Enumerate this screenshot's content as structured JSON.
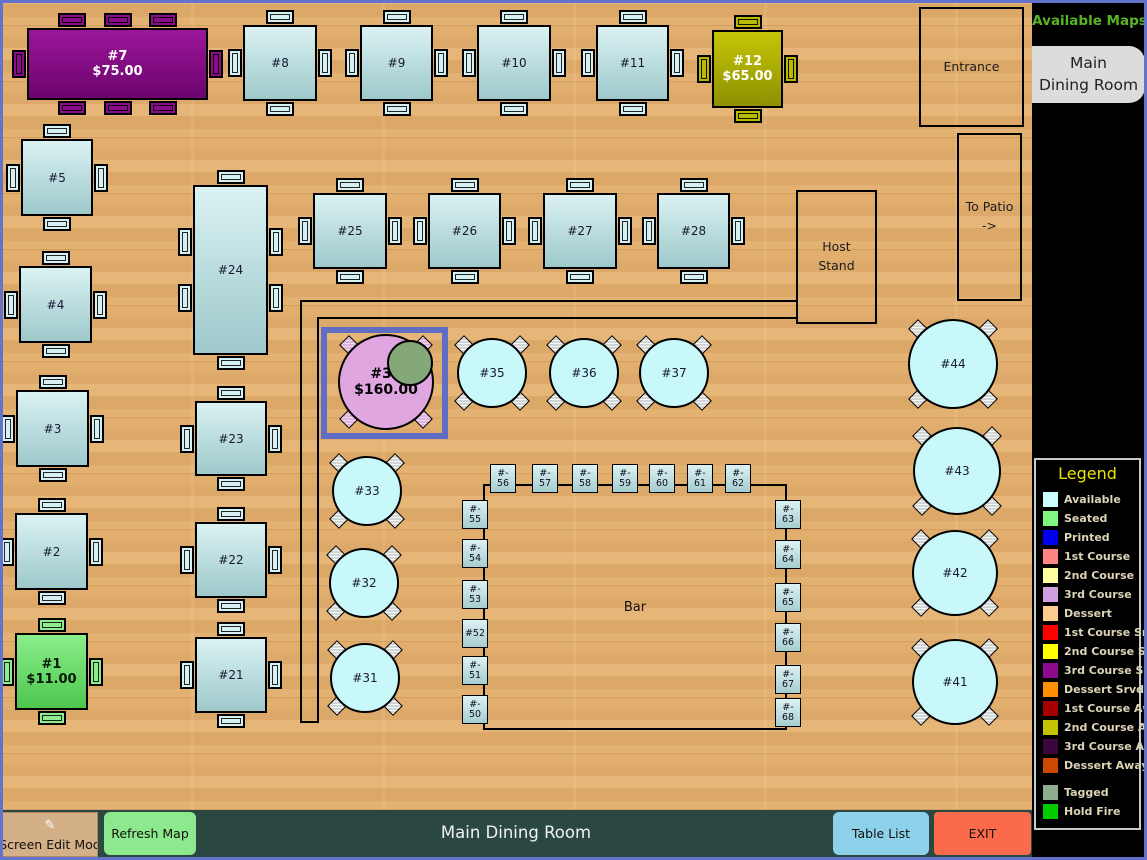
{
  "colors": {
    "frame": "#6372cb",
    "selection": "#5f6ec4",
    "wood": "#dfad6c",
    "bottombar": "#2b4741",
    "sidebar": "#000000"
  },
  "sidebar": {
    "title": "Available Maps",
    "active_map": "Main Dining Room",
    "active_map_lines": [
      "Main",
      "Dining Room"
    ],
    "legend": {
      "title": "Legend",
      "items": [
        {
          "label": "Available",
          "color": "#ccffff"
        },
        {
          "label": "Seated",
          "color": "#7ef87e"
        },
        {
          "label": "Printed",
          "color": "#0000f0"
        },
        {
          "label": "1st Course",
          "color": "#ff8585"
        },
        {
          "label": "2nd Course",
          "color": "#ffff9e"
        },
        {
          "label": "3rd Course",
          "color": "#cf9fe0"
        },
        {
          "label": "Dessert",
          "color": "#ffcc8e"
        },
        {
          "label": "1st Course Srvd",
          "color": "#ff0000"
        },
        {
          "label": "2nd Course Srvd",
          "color": "#ffff00"
        },
        {
          "label": "3rd Course Srvd",
          "color": "#8c0b8c"
        },
        {
          "label": "Dessert Srvd",
          "color": "#ff8e00"
        },
        {
          "label": "1st Course Away",
          "color": "#a40000"
        },
        {
          "label": "2nd Course Away",
          "color": "#c3c300"
        },
        {
          "label": "3rd Course Away",
          "color": "#3d063d"
        },
        {
          "label": "Dessert Away",
          "color": "#cc4a00"
        },
        {
          "label": "Tagged",
          "color": "#8cae8c",
          "gap": true
        },
        {
          "label": "Hold Fire",
          "color": "#00cc00"
        }
      ]
    }
  },
  "bottom_bar": {
    "edit_mode": "Screen Edit Mod",
    "refresh": "Refresh Map",
    "title": "Main Dining Room",
    "table_list": "Table List",
    "exit": "EXIT"
  },
  "map": {
    "walls": [
      {
        "x": 300,
        "y": 300,
        "w": 497,
        "h": 2
      },
      {
        "x": 317,
        "y": 317,
        "w": 480,
        "h": 2
      },
      {
        "x": 300,
        "y": 300,
        "w": 2,
        "h": 423
      },
      {
        "x": 317,
        "y": 317,
        "w": 2,
        "h": 404
      },
      {
        "x": 300,
        "y": 721,
        "w": 19,
        "h": 2
      }
    ],
    "rooms": [
      {
        "name": "entrance",
        "label": "Entrance",
        "x": 919,
        "y": 7,
        "w": 101,
        "h": 116
      },
      {
        "name": "to-patio",
        "label": "To Patio\n->",
        "x": 957,
        "y": 133,
        "w": 61,
        "h": 164
      },
      {
        "name": "host-stand",
        "label": "Host\nStand",
        "x": 796,
        "y": 190,
        "w": 77,
        "h": 130
      }
    ],
    "bar": {
      "label": "Bar",
      "x": 483,
      "y": 484,
      "w": 300,
      "h": 242,
      "seats": [
        {
          "lines": [
            "#-",
            "56"
          ],
          "x": 490,
          "y": 464
        },
        {
          "lines": [
            "#-",
            "57"
          ],
          "x": 532,
          "y": 464
        },
        {
          "lines": [
            "#-",
            "58"
          ],
          "x": 572,
          "y": 464
        },
        {
          "lines": [
            "#-",
            "59"
          ],
          "x": 612,
          "y": 464
        },
        {
          "lines": [
            "#-",
            "60"
          ],
          "x": 649,
          "y": 464
        },
        {
          "lines": [
            "#-",
            "61"
          ],
          "x": 687,
          "y": 464
        },
        {
          "lines": [
            "#-",
            "62"
          ],
          "x": 725,
          "y": 464
        },
        {
          "lines": [
            "#-",
            "55"
          ],
          "x": 462,
          "y": 500
        },
        {
          "lines": [
            "#-",
            "54"
          ],
          "x": 462,
          "y": 539
        },
        {
          "lines": [
            "#-",
            "53"
          ],
          "x": 462,
          "y": 580
        },
        {
          "lines": [
            "#52"
          ],
          "x": 462,
          "y": 619
        },
        {
          "lines": [
            "#-",
            "51"
          ],
          "x": 462,
          "y": 656
        },
        {
          "lines": [
            "#-",
            "50"
          ],
          "x": 462,
          "y": 695
        },
        {
          "lines": [
            "#-",
            "63"
          ],
          "x": 775,
          "y": 500
        },
        {
          "lines": [
            "#-",
            "64"
          ],
          "x": 775,
          "y": 540
        },
        {
          "lines": [
            "#-",
            "65"
          ],
          "x": 775,
          "y": 583
        },
        {
          "lines": [
            "#-",
            "66"
          ],
          "x": 775,
          "y": 623
        },
        {
          "lines": [
            "#-",
            "67"
          ],
          "x": 775,
          "y": 665
        },
        {
          "lines": [
            "#-",
            "68"
          ],
          "x": 775,
          "y": 698
        }
      ]
    },
    "rect_tables": [
      {
        "label": "#7",
        "amount": "$75.00",
        "x": 27,
        "y": 28,
        "w": 181,
        "h": 72,
        "fill": "srvd3",
        "chairs": {
          "top": 3,
          "bottom": 3,
          "left": 1,
          "right": 1
        }
      },
      {
        "label": "#8",
        "x": 243,
        "y": 25,
        "w": 74,
        "h": 76
      },
      {
        "label": "#9",
        "x": 360,
        "y": 25,
        "w": 73,
        "h": 76
      },
      {
        "label": "#10",
        "x": 477,
        "y": 25,
        "w": 74,
        "h": 76
      },
      {
        "label": "#11",
        "x": 596,
        "y": 25,
        "w": 73,
        "h": 76
      },
      {
        "label": "#12",
        "amount": "$65.00",
        "x": 712,
        "y": 30,
        "w": 71,
        "h": 78,
        "fill": "away2"
      },
      {
        "label": "#5",
        "x": 21,
        "y": 139,
        "w": 72,
        "h": 77
      },
      {
        "label": "#4",
        "x": 19,
        "y": 266,
        "w": 73,
        "h": 77
      },
      {
        "label": "#3",
        "x": 16,
        "y": 390,
        "w": 73,
        "h": 77
      },
      {
        "label": "#2",
        "x": 15,
        "y": 513,
        "w": 73,
        "h": 77
      },
      {
        "label": "#1",
        "amount": "$11.00",
        "x": 15,
        "y": 633,
        "w": 73,
        "h": 77,
        "fill": "seated"
      },
      {
        "label": "#24",
        "x": 193,
        "y": 185,
        "w": 75,
        "h": 170,
        "chairs": {
          "top": 1,
          "bottom": 1,
          "left": 2,
          "right": 2
        }
      },
      {
        "label": "#25",
        "x": 313,
        "y": 193,
        "w": 74,
        "h": 76
      },
      {
        "label": "#26",
        "x": 428,
        "y": 193,
        "w": 73,
        "h": 76
      },
      {
        "label": "#27",
        "x": 543,
        "y": 193,
        "w": 74,
        "h": 76
      },
      {
        "label": "#28",
        "x": 657,
        "y": 193,
        "w": 73,
        "h": 76
      },
      {
        "label": "#23",
        "x": 195,
        "y": 401,
        "w": 72,
        "h": 75
      },
      {
        "label": "#22",
        "x": 195,
        "y": 522,
        "w": 72,
        "h": 76
      },
      {
        "label": "#21",
        "x": 195,
        "y": 637,
        "w": 72,
        "h": 76
      }
    ],
    "round_tables": [
      {
        "label": "#34",
        "amount": "$160.00",
        "cx": 386,
        "cy": 382,
        "r": 48,
        "fill": "course3",
        "selected": {
          "x": 321,
          "y": 327,
          "w": 127,
          "h": 112
        },
        "tagged": {
          "cx": 408,
          "cy": 361,
          "r": 21
        }
      },
      {
        "label": "#35",
        "cx": 492,
        "cy": 373,
        "r": 35
      },
      {
        "label": "#36",
        "cx": 584,
        "cy": 373,
        "r": 35
      },
      {
        "label": "#37",
        "cx": 674,
        "cy": 373,
        "r": 35
      },
      {
        "label": "#33",
        "cx": 367,
        "cy": 491,
        "r": 35
      },
      {
        "label": "#32",
        "cx": 364,
        "cy": 583,
        "r": 35
      },
      {
        "label": "#31",
        "cx": 365,
        "cy": 678,
        "r": 35
      },
      {
        "label": "#44",
        "cx": 953,
        "cy": 364,
        "r": 45
      },
      {
        "label": "#43",
        "cx": 957,
        "cy": 471,
        "r": 44
      },
      {
        "label": "#42",
        "cx": 955,
        "cy": 573,
        "r": 43
      },
      {
        "label": "#41",
        "cx": 955,
        "cy": 682,
        "r": 43
      }
    ]
  }
}
